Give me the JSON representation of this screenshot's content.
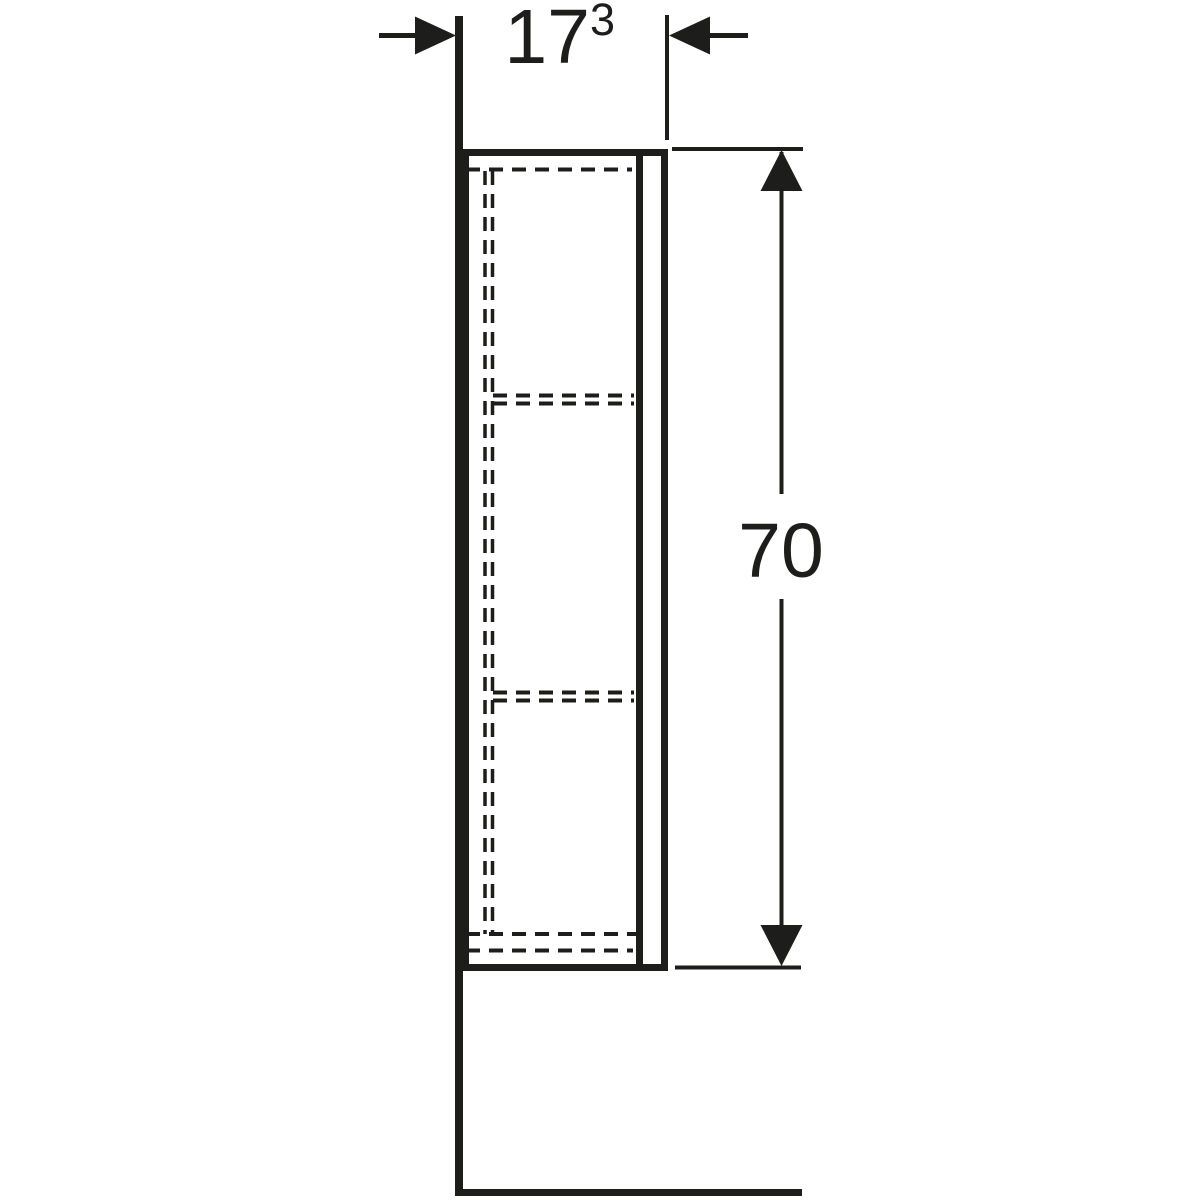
{
  "drawing": {
    "background": "#ffffff",
    "line_color": "#1d1d1b",
    "labels": {
      "depth": {
        "value": "17",
        "superscript": "3"
      },
      "height": {
        "value": "70"
      }
    }
  }
}
